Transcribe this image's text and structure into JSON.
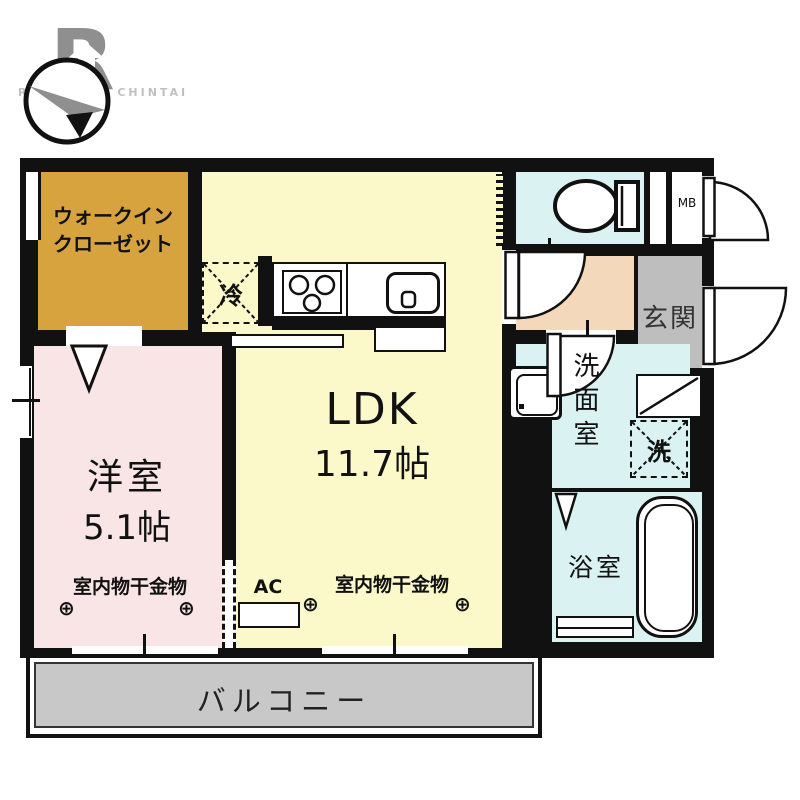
{
  "branding": {
    "watermark": "RAKURAKU CHINTAI",
    "logo_letter": "R"
  },
  "rooms": {
    "wic": {
      "line1": "ウォークイン",
      "line2": "クローゼット"
    },
    "ldk": {
      "name": "LDK",
      "size": "11.7帖"
    },
    "western": {
      "name": "洋室",
      "size": "5.1帖"
    },
    "genkan": {
      "label": "玄関"
    },
    "washroom": {
      "label": "洗面室"
    },
    "bathroom": {
      "label": "浴室"
    },
    "balcony": {
      "label": "バルコニー"
    }
  },
  "fixtures": {
    "fridge": "冷",
    "washer": "洗",
    "meter_box": "MB",
    "ac": "AC"
  },
  "annotations": {
    "hang_left": "室内物干金物",
    "hang_right": "室内物干金物",
    "anchor_symbol": "⊕"
  },
  "colors": {
    "wall": "#111111",
    "wic": "#d7a33f",
    "ldk": "#fbf9ca",
    "western": "#f9e5e5",
    "wet_area": "#dbf2f2",
    "hall": "#f4d8bb",
    "genkan": "#bebebe",
    "balcony": "#c8c8c8"
  }
}
